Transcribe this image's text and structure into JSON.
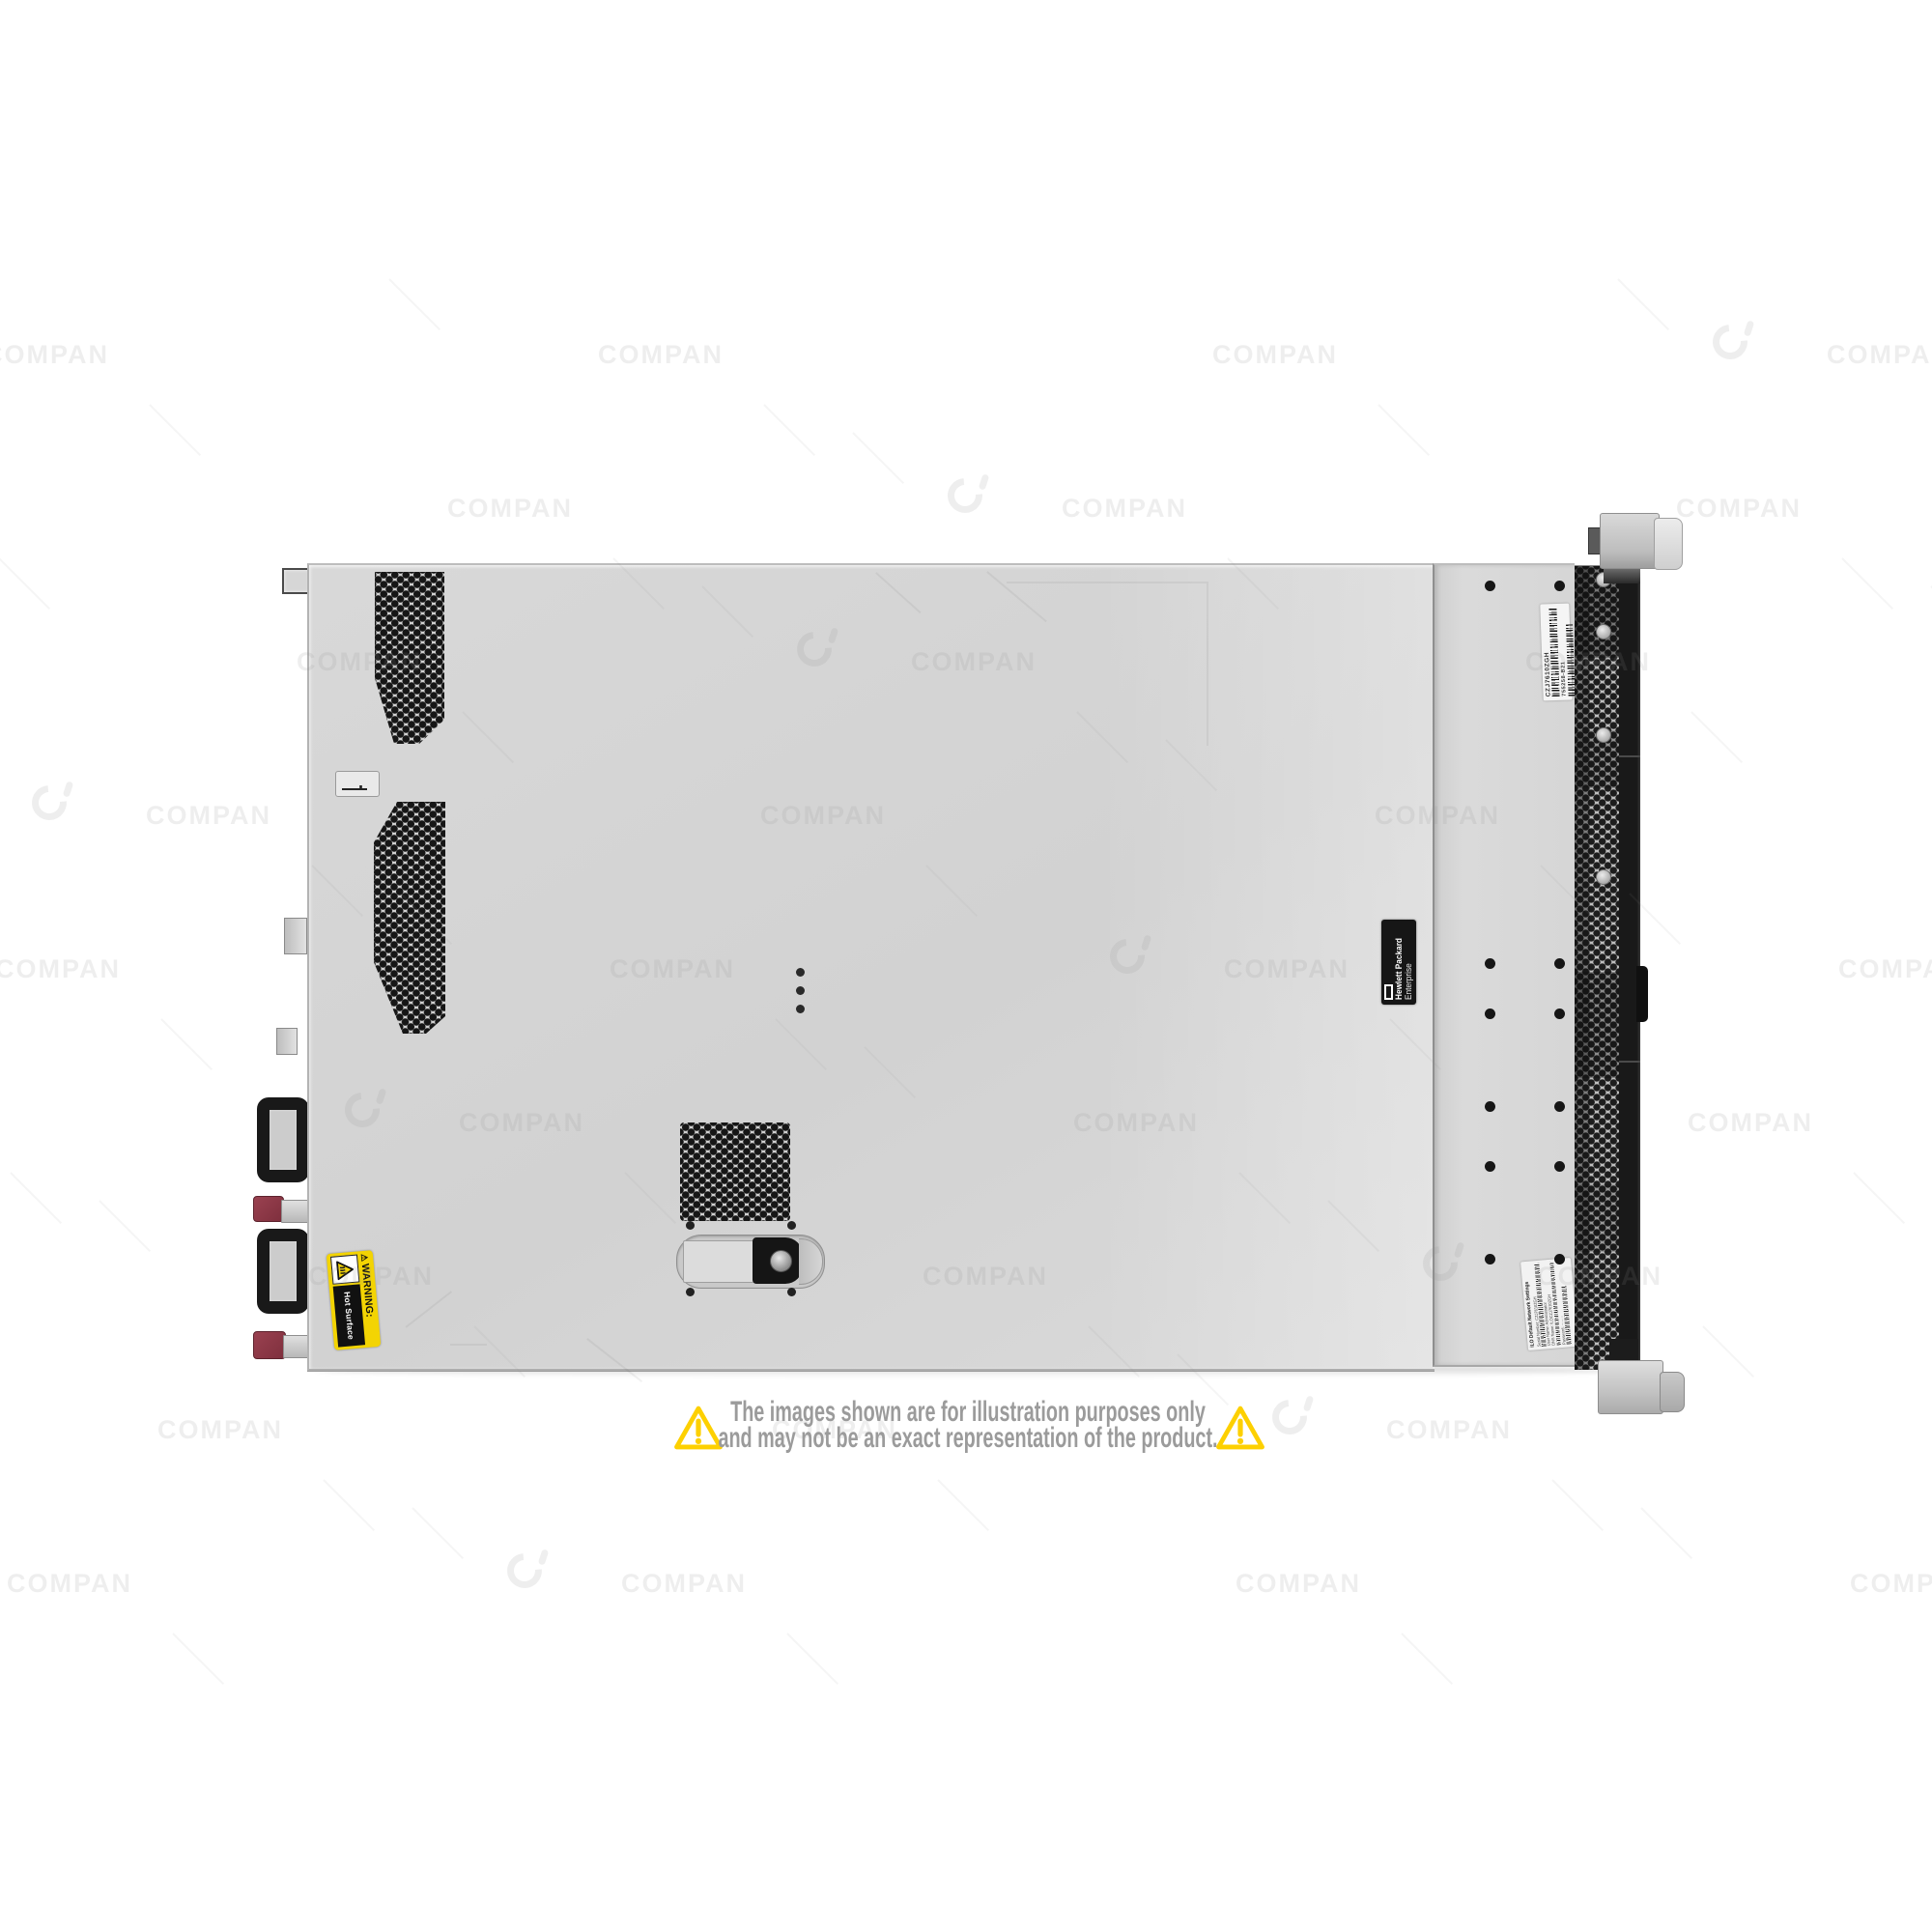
{
  "photo": {
    "subject": "rack-server-top-view",
    "watermark": {
      "text": "COMPAN",
      "logo": "ci-ring-logo",
      "color": "#8f8f8f"
    },
    "labels": {
      "brand": {
        "line1": "Hewlett Packard",
        "line2": "Enterprise"
      },
      "serial_label": {
        "serial": "CZJ7610ZGH",
        "part_number": "755258-B21"
      },
      "ilo_label": {
        "title": "iLO Default Network Settings",
        "lines": [
          "Serial Number: CZJ7610ZGH",
          "User Name: Administrator",
          "DNS Name: ILOCZJ7610ZGH",
          "Password: ········"
        ]
      },
      "warning_label": {
        "icon": "⚠",
        "title": "WARNING:",
        "body": "Hot Surface"
      }
    }
  },
  "disclaimer": {
    "line1": "The images shown are for illustration purposes only",
    "line2": "and may not be an exact representation of the product."
  },
  "colors": {
    "chassis": "#d8d8d8",
    "front_panel": "#d9d9d9",
    "bezel": "#191919",
    "vent_hole": "#161616",
    "latch_maroon": "#9a4150",
    "warning_yellow": "#f3d403",
    "disclaimer_yellow": "#fdd000",
    "disclaimer_text": "#9b9b9b",
    "wm": "#8f8f8f"
  }
}
